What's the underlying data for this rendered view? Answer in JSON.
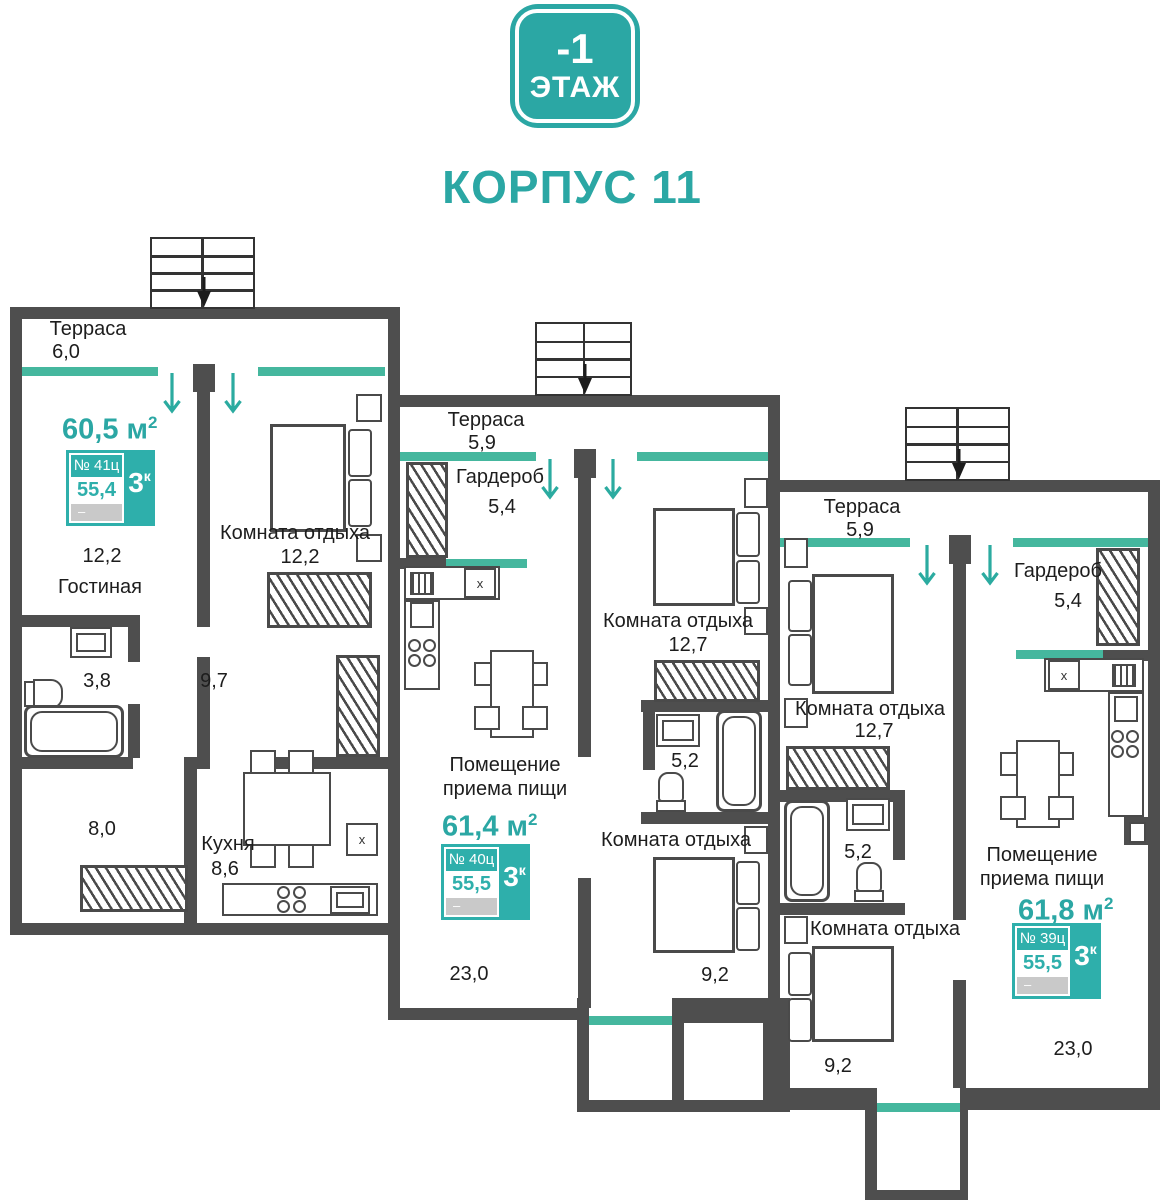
{
  "header": {
    "floor_number": "-1",
    "floor_word": "ЭТАЖ",
    "building": "КОРПУС 11"
  },
  "units": {
    "u41": {
      "total": "60,5",
      "unit": "м",
      "sup": "2",
      "number": "№ 41ц",
      "rooms_count": "3",
      "rooms_sup": "к",
      "living": "55,4",
      "dash": "–",
      "terrace": "Терраса",
      "terrace_a": "6,0",
      "bedroom": "Комната отдыха",
      "bedroom_a": "12,2",
      "living_room": "Гостиная",
      "living_room_a": "12,2",
      "bath_a": "3,8",
      "hall_a": "9,7",
      "room_a": "8,0",
      "kitchen": "Кухня",
      "kitchen_a": "8,6"
    },
    "u40": {
      "total": "61,4",
      "unit": "м",
      "sup": "2",
      "number": "№ 40ц",
      "rooms_count": "3",
      "rooms_sup": "к",
      "living": "55,5",
      "dash": "–",
      "terrace": "Терраса",
      "terrace_a": "5,9",
      "wardrobe": "Гардероб",
      "wardrobe_a": "5,4",
      "bedroom1": "Комната отдыха",
      "bedroom1_a": "12,7",
      "bath_a": "5,2",
      "bedroom2": "Комната отдыха",
      "bedroom2_a": "9,2",
      "dining1": "Помещение",
      "dining2": "приема пищи",
      "dining_a": "23,0"
    },
    "u39": {
      "total": "61,8",
      "unit": "м",
      "sup": "2",
      "number": "№ 39ц",
      "rooms_count": "3",
      "rooms_sup": "к",
      "living": "55,5",
      "dash": "–",
      "terrace": "Терраса",
      "terrace_a": "5,9",
      "wardrobe": "Гардероб",
      "wardrobe_a": "5,4",
      "bedroom1": "Комната отдыха",
      "bedroom1_a": "12,7",
      "bath_a": "5,2",
      "bedroom2": "Комната отдыха",
      "bedroom2_a": "9,2",
      "dining1": "Помещение",
      "dining2": "приема пищи",
      "dining_a": "23,0"
    }
  },
  "icons": {
    "fridge_mark": "x"
  },
  "colors": {
    "teal": "#2BA7A4",
    "window_teal": "#45B79E",
    "wall_gray": "#4E4E4E"
  }
}
